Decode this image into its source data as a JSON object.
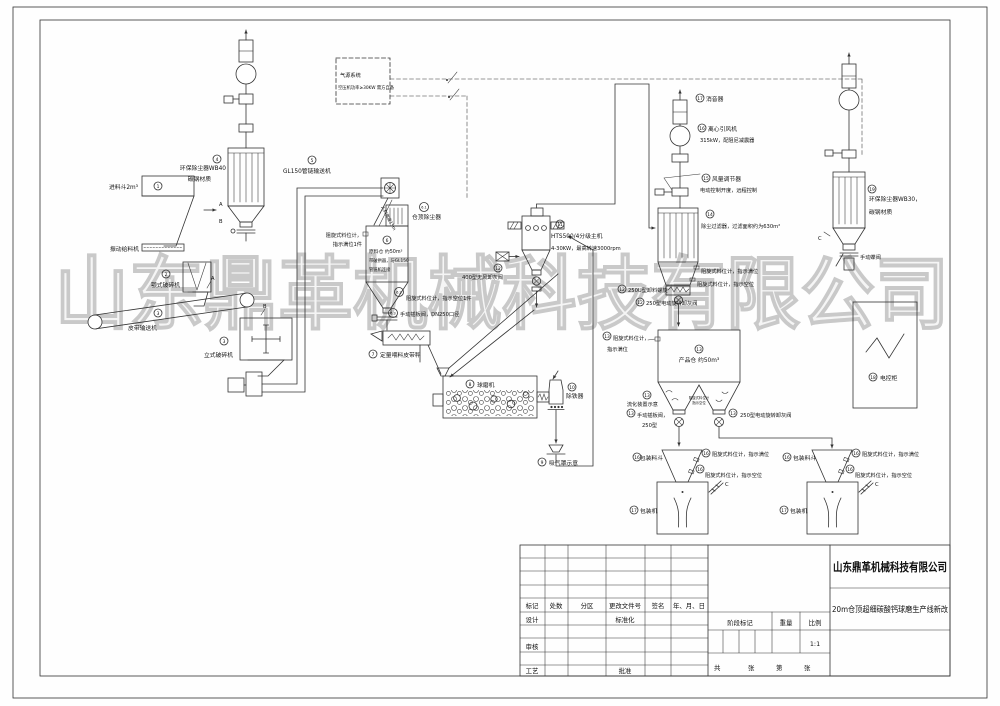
{
  "drawing": {
    "watermark": "山东鼎革机械科技有限公司",
    "air_system": {
      "title": "气源系统",
      "note": "空压机功率≥30KW 需方自备"
    },
    "markers": {
      "a": "A",
      "b": "B",
      "c": "C"
    },
    "nums": {
      "n1": "1",
      "n2": "2",
      "n3": "3",
      "n4": "4",
      "n5": "5",
      "n6": "6",
      "n6_1": "6.1",
      "n6_2": "6.2",
      "n6_3": "6.3",
      "n7": "7",
      "n8": "8",
      "n9": "9",
      "n10": "10",
      "n11": "11",
      "n12": "12",
      "n13": "13",
      "n14": "14",
      "n15": "15",
      "n16": "16",
      "n17": "17",
      "n18": "18",
      "n19": "19"
    },
    "labels": {
      "feed_hopper": "进料斗2m³",
      "vib_feeder": "振动给料机",
      "jaw_crusher": "颚式破碎机",
      "belt_conveyor": "皮带输送机",
      "vert_crusher": "立式破碎机",
      "wb40_1": "环保除尘器WB40",
      "wb40_2": "碳钢材质",
      "gl150": "GL150管链输送机",
      "chute_note": "入料高度15m",
      "silo_top_dc": "仓顶除尘器",
      "lvl_full_1a": "阻旋式料位计，",
      "lvl_full_1b": "指示满位1件",
      "silo_1": "原料仓 约50m³",
      "silo_2": "带破拱器，与GL150",
      "silo_3": "管链机连接",
      "lvl_empty_1": "阻旋式料位计，指示空位1件",
      "gate_dn250": "手动插板阀，DN250口径",
      "belt_scale": "定量喂料皮带秤",
      "ball_mill": "球磨机",
      "iron_remover": "除铁器",
      "suction_hood": "吸气罩示意",
      "classifier_1": "HTS500/4分级主机",
      "classifier_2": "4-30KW，最高转速3000rpm",
      "ash_valve_400": "400型无风卸灰阀",
      "silencer": "消音器",
      "fan_1": "离心引风机",
      "fan_2": "315kW，配阻尼减震器",
      "damper_1": "风量调节器",
      "damper_2": "电动控制开度，远程控制",
      "filter": "除尘过滤器，过滤面积约为630m²",
      "lvl_full_2": "阻旋式料位计，指示满位",
      "lvl_empty_2": "阻旋式料位计，指示空位",
      "screw_250u": "250U型卸料螺旋",
      "rotary_250": "250型电动旋转卸灰阀",
      "lvl_full_3a": "阻旋式料位计，",
      "lvl_full_3b": "指示满位",
      "product_silo": "产品仓 约50m³",
      "fluidizer": "流化装置示意",
      "gate_250a": "手动插板阀，",
      "gate_250b": "250型",
      "lvl_empty_3a": "阻旋式料位计",
      "lvl_empty_3b": "指示空位",
      "rotary_250_r": "250型电动旋转卸灰阀",
      "pack_hopper": "包装料斗",
      "pack_machine": "包装机",
      "lvl_full_4": "阻旋式料位计，指示满位",
      "lvl_empty_4": "阻旋式料位计，指示空位",
      "wb30_1": "环保除尘器WB30，",
      "wb30_2": "碳钢材质",
      "butterfly": "手动蝶阀",
      "cabinet": "电控柜"
    },
    "title_block": {
      "company": "山东鼎革机械科技有限公司",
      "drawing_title": "20m仓顶超细碳酸钙球磨生产线新改",
      "header": [
        "标记",
        "处数",
        "分区",
        "更改文件号",
        "签名",
        "年、月、日"
      ],
      "design": "设计",
      "standardize": "标准化",
      "review": "审核",
      "process": "工艺",
      "approve": "批准",
      "stage_mark": "阶段标记",
      "weight": "重量",
      "scale": "比例",
      "scale_value": "1:1",
      "total": "共",
      "sheet1": "张",
      "page": "第",
      "sheet2": "张"
    }
  }
}
